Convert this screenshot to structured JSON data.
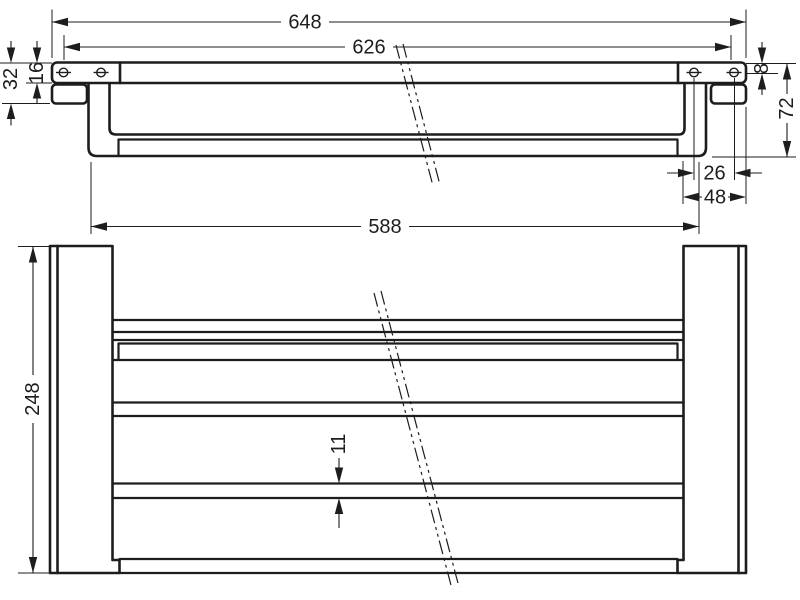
{
  "drawing": {
    "type": "technical-dimension-drawing",
    "views": [
      "front-elevation",
      "plan-view"
    ]
  },
  "front_view": {
    "overall_width": "648",
    "mounting_width": "626",
    "bracket_offset": "32",
    "plate_height": "16",
    "shelf_edge_thickness": "8",
    "bracket_height": "72",
    "hole_spacing": "26",
    "plate_width": "48"
  },
  "plan_view": {
    "bar_length": "588",
    "depth": "248",
    "wire_width": "11"
  },
  "colors": {
    "line": "#1d1d1d",
    "background": "#ffffff"
  }
}
